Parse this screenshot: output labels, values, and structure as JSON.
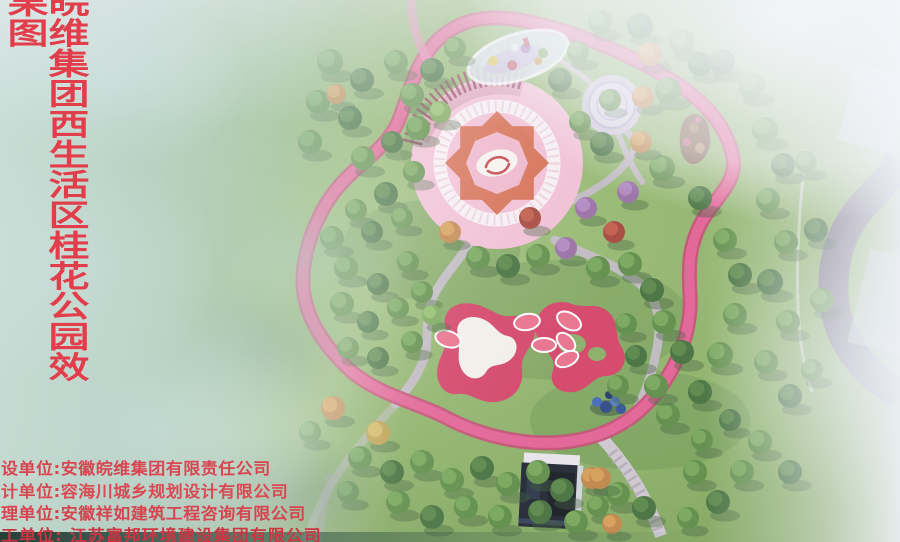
{
  "title": {
    "text": "皖维集团西生活区桂花公园效果图"
  },
  "credits": {
    "lines": [
      "设单位:安徽皖维集团有限责任公司",
      "计单位:容海川城乡规划设计有限公司",
      "理单位:安徽祥如建筑工程咨询有限公司",
      "工单位: 江苏富邦环境建设集团有限公司"
    ]
  },
  "colors": {
    "title_red": "#e13d4b",
    "credit_red": "#d84550",
    "loop_pink": "#e25b90",
    "plaza_pink": "#f1bdd3",
    "mandala_orange": "#d4674a",
    "playground_red": "#d23a60",
    "lawn_green": "#86ac60",
    "path_grey": "#bdb7be",
    "haze_teal": "#bcd8d0",
    "road_purple": "#6a5680"
  }
}
